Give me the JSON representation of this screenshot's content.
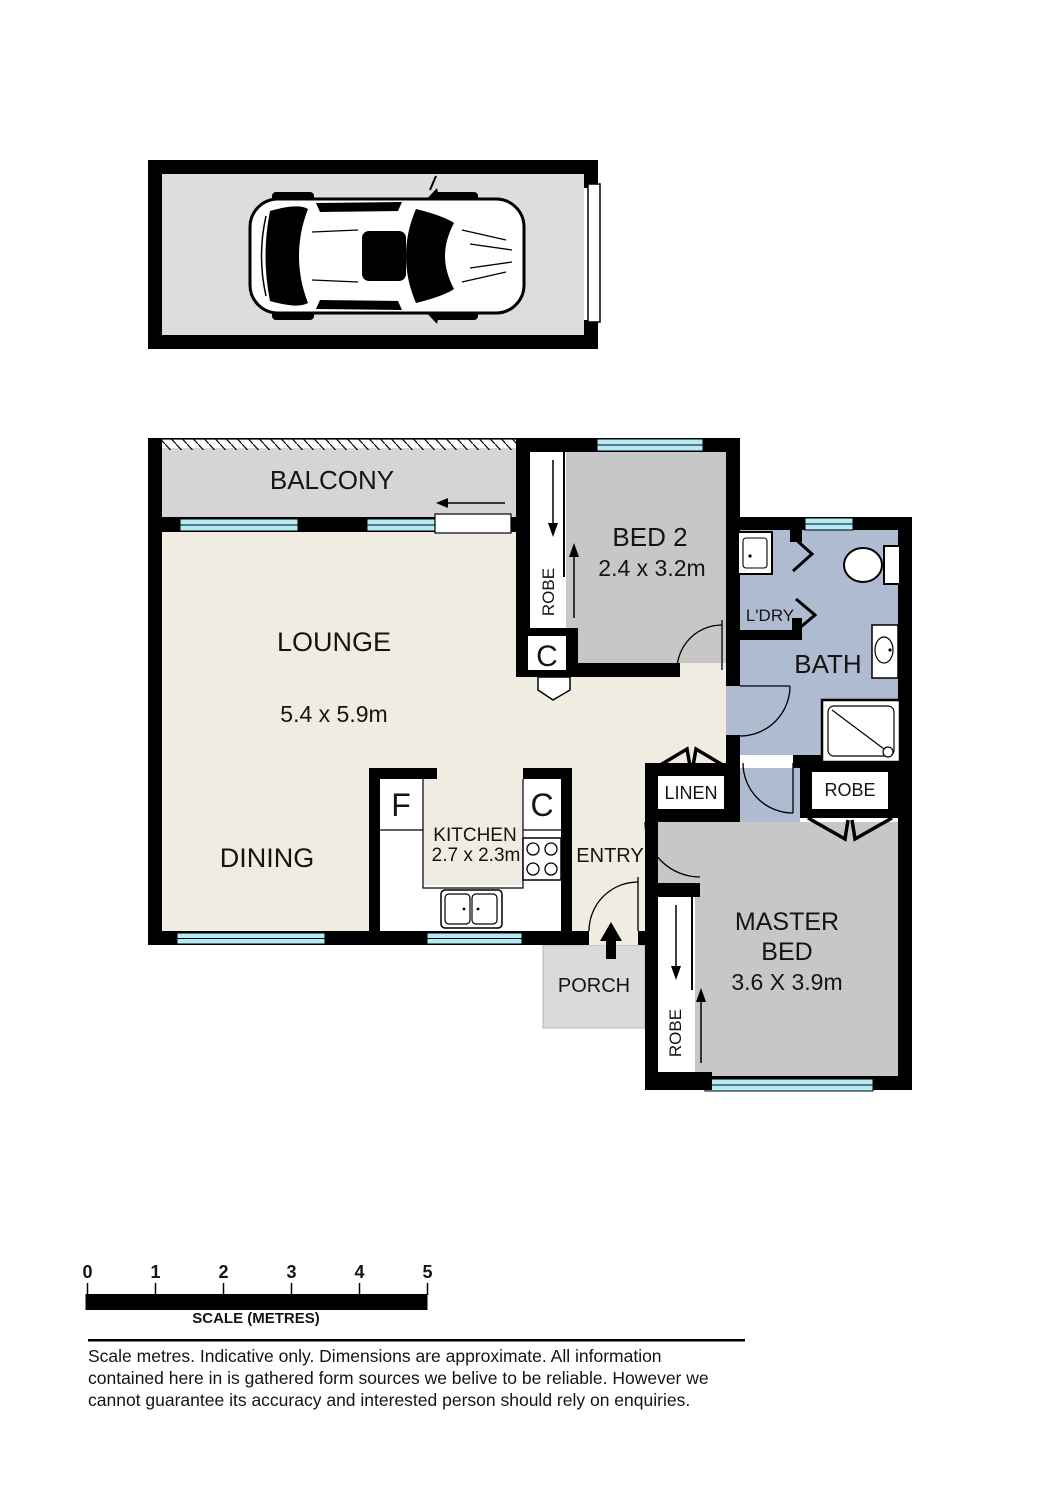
{
  "rooms": {
    "balcony": {
      "label": "BALCONY"
    },
    "lounge": {
      "label": "LOUNGE",
      "dims": "5.4 x 5.9m"
    },
    "dining": {
      "label": "DINING"
    },
    "bed2": {
      "label": "BED 2",
      "dims": "2.4 x 3.2m"
    },
    "master": {
      "label_line1": "MASTER",
      "label_line2": "BED",
      "dims": "3.6 X 3.9m"
    },
    "kitchen": {
      "label": "KITCHEN",
      "dims": "2.7 x 2.3m"
    },
    "bath": {
      "label": "BATH"
    },
    "laundry": {
      "label": "L'DRY"
    },
    "entry": {
      "label": "ENTRY"
    },
    "porch": {
      "label": "PORCH"
    },
    "linen": {
      "label": "LINEN"
    }
  },
  "closets": {
    "bed2_robe": "ROBE",
    "master_robe": "ROBE",
    "bath_robe": "ROBE",
    "hall_cupboard": "C",
    "kitchen_cupboard": "C",
    "kitchen_fridge": "F"
  },
  "scale_bar": {
    "ticks": [
      "0",
      "1",
      "2",
      "3",
      "4",
      "5"
    ],
    "label": "SCALE (METRES)"
  },
  "disclaimer": {
    "line1": "Scale metres. Indicative only. Dimensions are approximate. All information",
    "line2": "contained here in is gathered form sources we belive to be reliable. However we",
    "line3": "cannot guarantee its accuracy and interested person should rely on enquiries."
  },
  "colors": {
    "wall": "#000000",
    "floor_cream": "#f1ece2",
    "bedroom_grey": "#c7c7c7",
    "bath_blue": "#aebbd0",
    "balcony_grey": "#d5d5d5",
    "porch_grey": "#dadada",
    "garage_grey": "#dddddd",
    "window_cyan": "#b2ebf4"
  }
}
